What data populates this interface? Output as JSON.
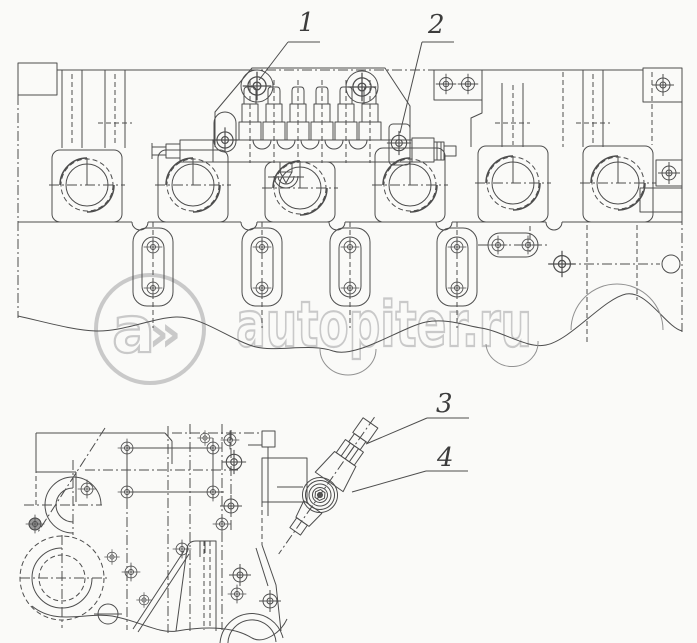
{
  "drawing": {
    "callouts": [
      {
        "number": "1"
      },
      {
        "number": "2"
      },
      {
        "number": "3"
      },
      {
        "number": "4"
      }
    ],
    "watermark": {
      "logo_letter": "a",
      "logo_arrows": "»",
      "text": "autopiter.ru"
    },
    "colors": {
      "line": "#4d4d4d",
      "watermark": "#c9c9c9",
      "background": "#fafaf8"
    }
  }
}
